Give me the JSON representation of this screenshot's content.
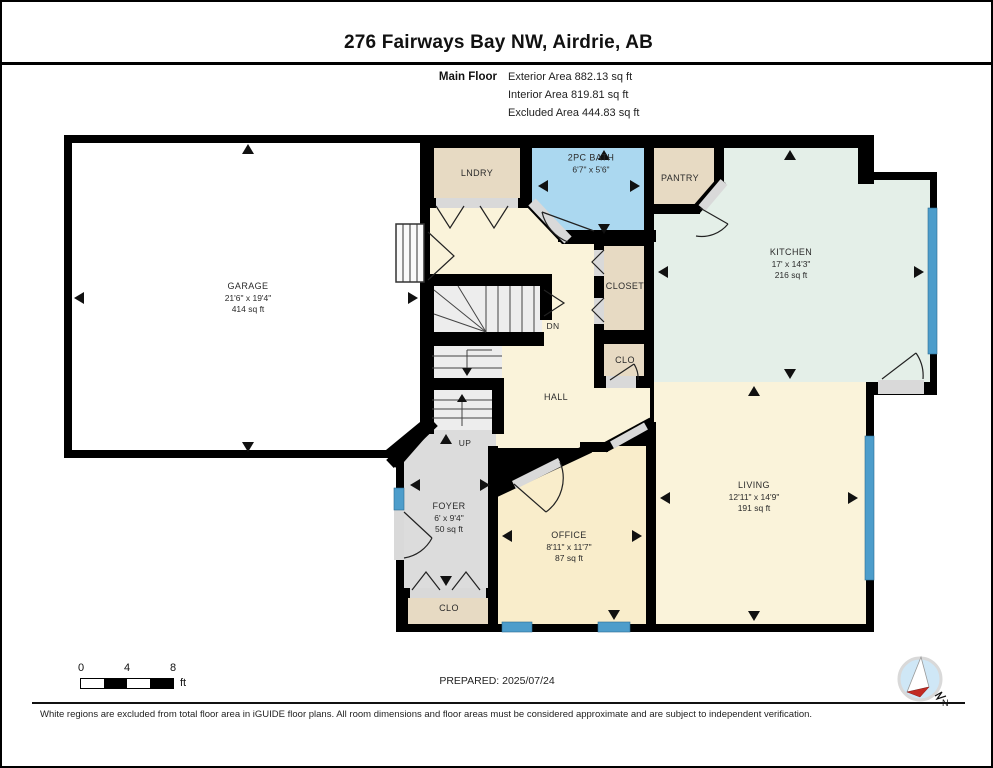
{
  "header": {
    "title": "276 Fairways Bay NW, Airdrie, AB",
    "floor_label": "Main Floor",
    "area_lines": [
      "Exterior Area 882.13 sq ft",
      "Interior Area 819.81 sq ft",
      "Excluded Area 444.83 sq ft"
    ]
  },
  "rooms": {
    "garage": {
      "name": "GARAGE",
      "dims": "21'6\" x 19'4\"",
      "area": "414 sq ft"
    },
    "laundry": {
      "name": "LNDRY"
    },
    "bath": {
      "name": "2PC BATH",
      "dims": "6'7\" x 5'6\""
    },
    "pantry": {
      "name": "PANTRY"
    },
    "kitchen": {
      "name": "KITCHEN",
      "dims": "17' x 14'3\"",
      "area": "216 sq ft"
    },
    "closet": {
      "name": "CLOSET"
    },
    "closet_hall": {
      "name": "CLO"
    },
    "hall": {
      "name": "HALL"
    },
    "stairs_down": {
      "label": "DN"
    },
    "stairs_up": {
      "label": "UP"
    },
    "foyer": {
      "name": "FOYER",
      "dims": "6' x 9'4\"",
      "area": "50 sq ft"
    },
    "closet_foyer": {
      "name": "CLO"
    },
    "office": {
      "name": "OFFICE",
      "dims": "8'11\" x 11'7\"",
      "area": "87 sq ft"
    },
    "living": {
      "name": "LIVING",
      "dims": "12'11\" x 14'9\"",
      "area": "191 sq ft"
    }
  },
  "scale_bar": {
    "ticks": [
      "0",
      "4",
      "8"
    ],
    "unit": "ft"
  },
  "footer": {
    "prepared": "PREPARED: 2025/07/24",
    "compass_north": "N",
    "disclaimer": "White regions are excluded from total floor area in iGUIDE floor plans. All room dimensions and floor areas must be considered approximate and are subject to independent verification."
  },
  "colors": {
    "wall": "#000000",
    "garage": "#ffffff",
    "tan": "#e7dac3",
    "bath_blue": "#abd8f0",
    "kitchen_green": "#e4efe8",
    "cream": "#faf3da",
    "office_cream": "#f9edcb",
    "foyer_gray": "#dcdcdc",
    "stairs_gray": "#ededed",
    "window_blue": "#4d9dcb",
    "threshold_gray": "#d9d9d9"
  }
}
